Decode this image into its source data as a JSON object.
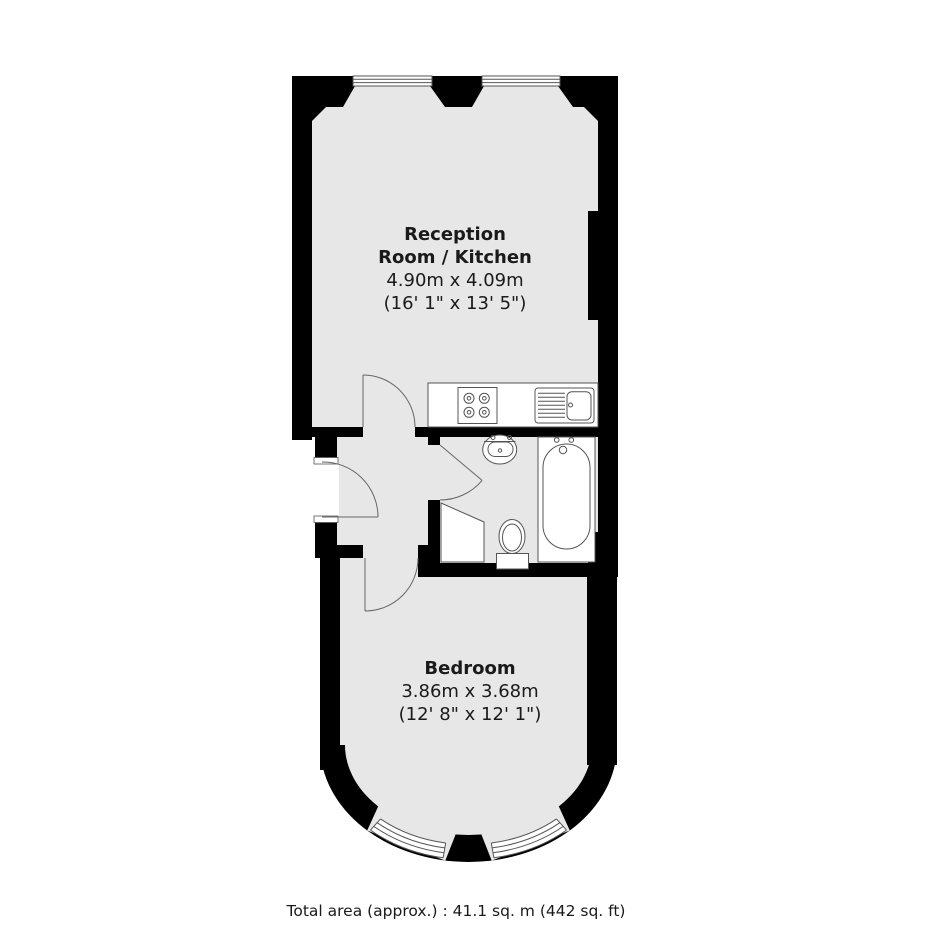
{
  "rooms": {
    "reception": {
      "name_line1": "Reception",
      "name_line2": "Room / Kitchen",
      "dims_metric": "4.90m x 4.09m",
      "dims_imperial": "(16' 1\" x 13' 5\")"
    },
    "bedroom": {
      "name": "Bedroom",
      "dims_metric": "3.86m x 3.68m",
      "dims_imperial": "(12' 8\" x 12' 1\")"
    }
  },
  "footer": {
    "total_area": "Total area (approx.) : 41.1 sq. m (442 sq. ft)"
  },
  "fixtures": {
    "kitchen": [
      "kitchen-counter",
      "hob",
      "sink-with-drainer"
    ],
    "bathroom": [
      "wash-basin",
      "toilet",
      "bathtub",
      "shower"
    ],
    "doors": [
      "entrance-door",
      "reception-door",
      "bathroom-door",
      "bedroom-door"
    ],
    "windows": [
      "top-window-left",
      "top-window-right",
      "bay-window-left",
      "bay-window-right"
    ]
  },
  "colors": {
    "wall": "#000000",
    "floor": "#e7e7e7",
    "fixture_outline": "#555555",
    "background": "#ffffff",
    "text": "#1a1a1a"
  }
}
